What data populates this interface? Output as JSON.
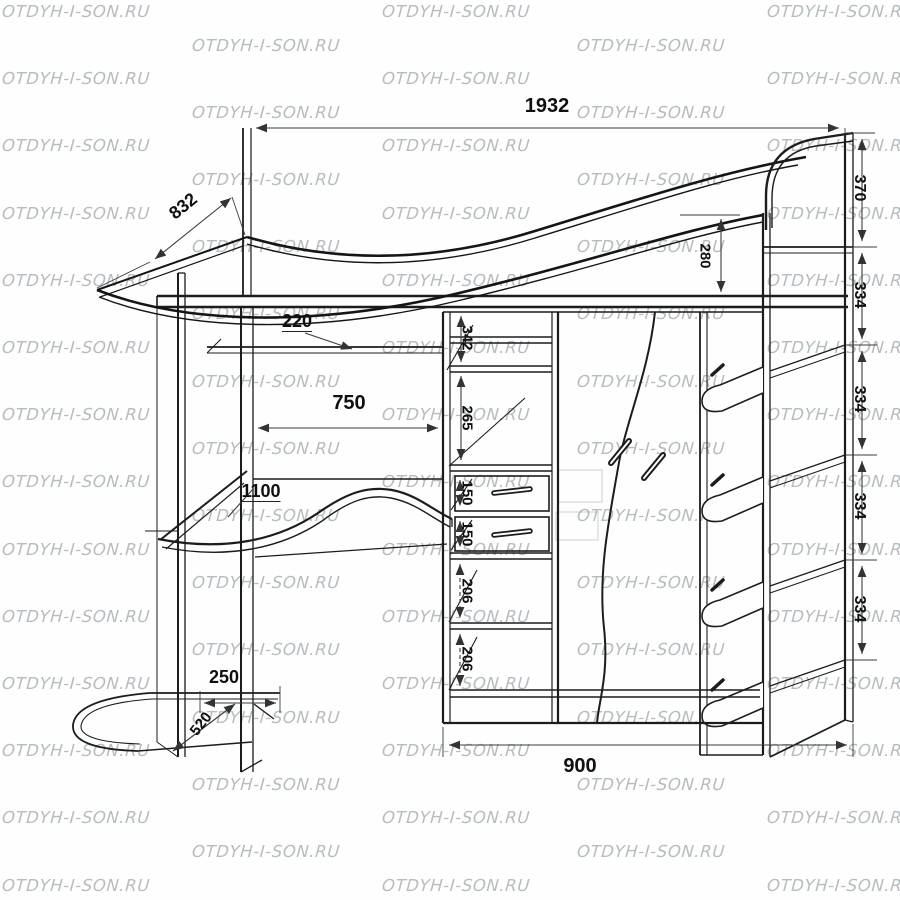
{
  "watermark": {
    "text": "OTDYH-I-SON.RU"
  },
  "dims": {
    "overall_width": "1932",
    "bed_depth": "832",
    "headboard_height": "370",
    "right_shelf_gaps": [
      "334",
      "334",
      "334",
      "334"
    ],
    "rail_height": "280",
    "cubby_342": "342",
    "cubby_265": "265",
    "drawer_150_top": "150",
    "drawer_150_bottom": "150",
    "cubby_206_top": "206",
    "cubby_206_bottom": "206",
    "shelf_depth_220": "220",
    "desk_clearance_750": "750",
    "desk_width_1100": "1100",
    "tray_width_250": "250",
    "tray_depth_520": "520",
    "base_width_900": "900"
  }
}
